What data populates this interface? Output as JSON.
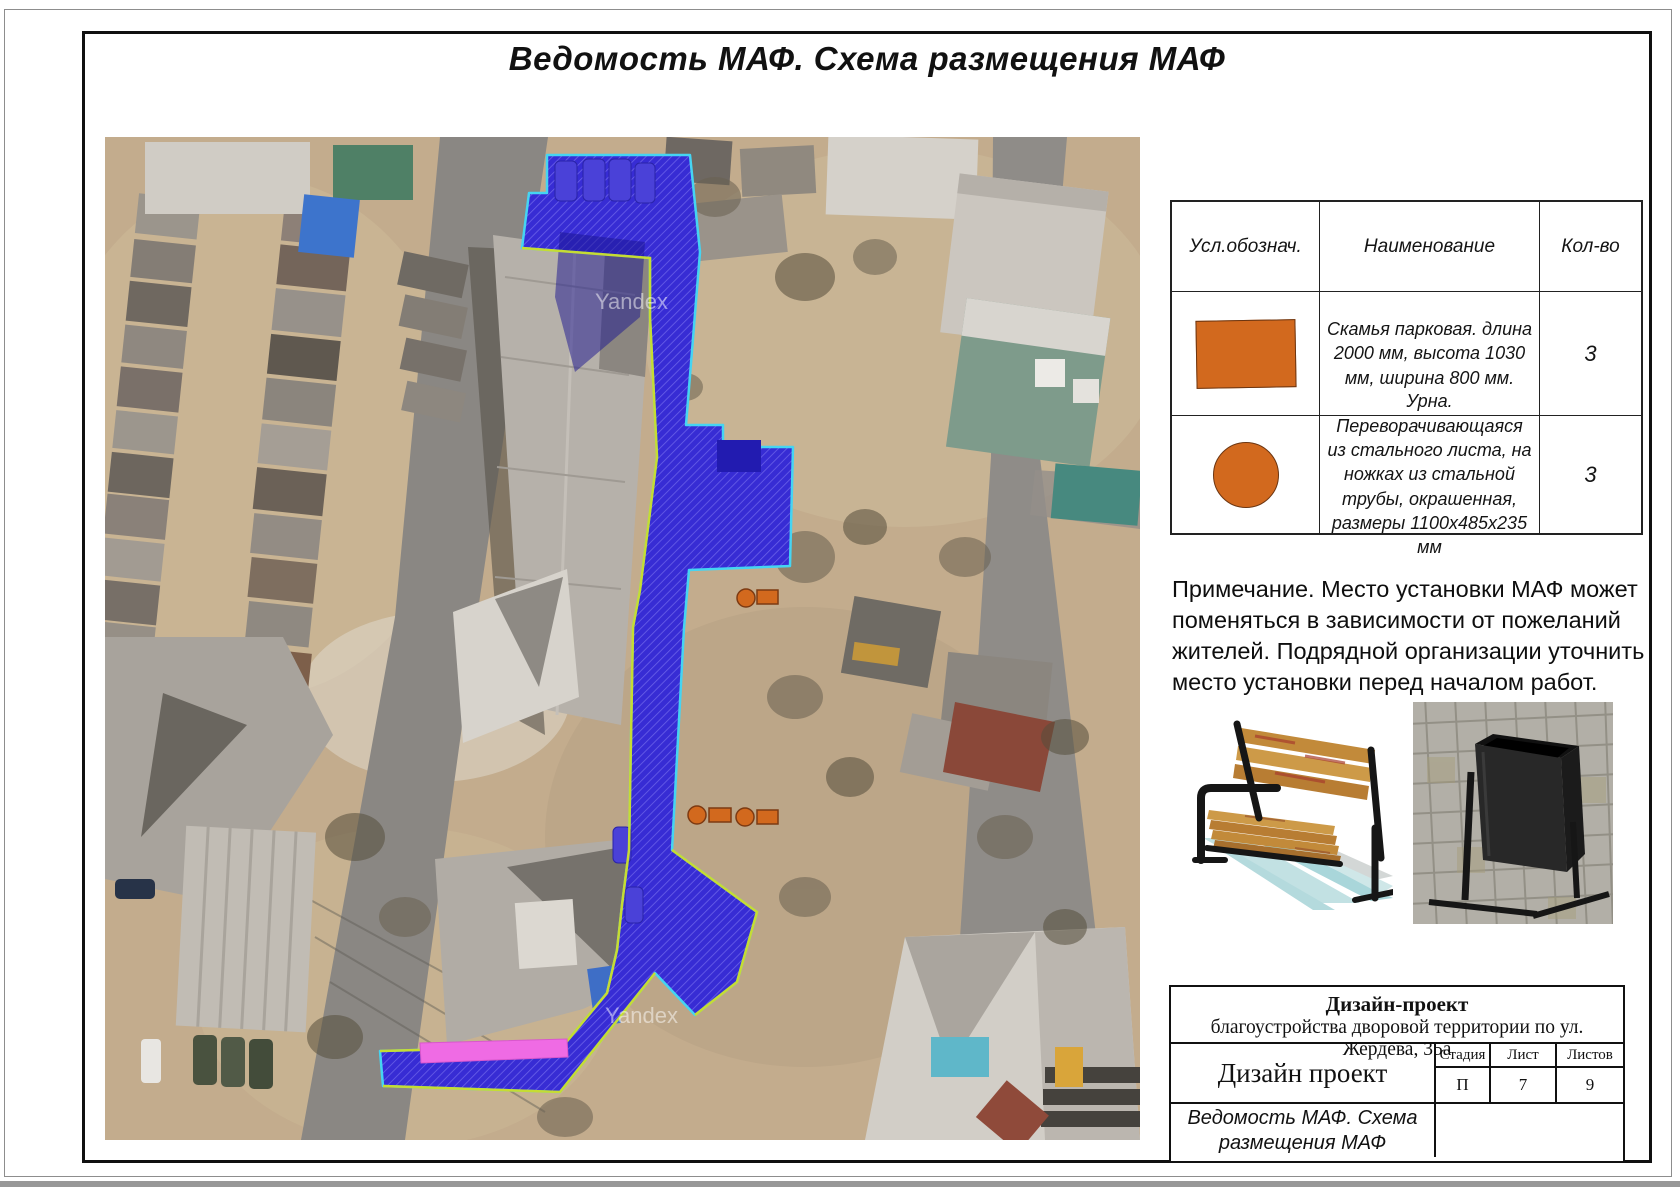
{
  "page": {
    "title": "Ведомость МАФ. Схема размещения МАФ"
  },
  "table": {
    "headers": {
      "symbol": "Усл.обознач.",
      "name": "Наименование",
      "qty": "Кол-во"
    },
    "rows": [
      {
        "symbol": "orange-rectangle",
        "name": "Скамья парковая. длина 2000 мм, высота 1030 мм, ширина 800 мм.",
        "qty": "3"
      },
      {
        "symbol": "orange-circle",
        "name": "Урна. Переворачивающаяся из стального листа, на ножках из стальной трубы, окрашенная, размеры 1100х485х235 мм",
        "qty": "3"
      }
    ]
  },
  "note": "Примечание. Место установки МАФ может поменяться в зависимости от пожеланий жителей. Подрядной организации уточнить место установки перед началом работ.",
  "map": {
    "watermark": "Yandex"
  },
  "title_block": {
    "project_bold": "Дизайн-проект",
    "project_rest": "благоустройства дворовой территории по ул. Жердева, 35а",
    "org": "Дизайн проект",
    "stage_label": "Стадия",
    "stage": "П",
    "sheet_label": "Лист",
    "sheet": "7",
    "sheets_label": "Листов",
    "sheets": "9",
    "sheet_title": "Ведомость МАФ. Схема размещения МАФ"
  },
  "colors": {
    "overlay_blue": "#372cd4",
    "overlay_hatch": "#6a61e8",
    "outline_cyan": "#45d4f2",
    "outline_green": "#c6dc33",
    "highlight_pink": "#ef6be4",
    "symbol_orange": "#d2691e"
  }
}
